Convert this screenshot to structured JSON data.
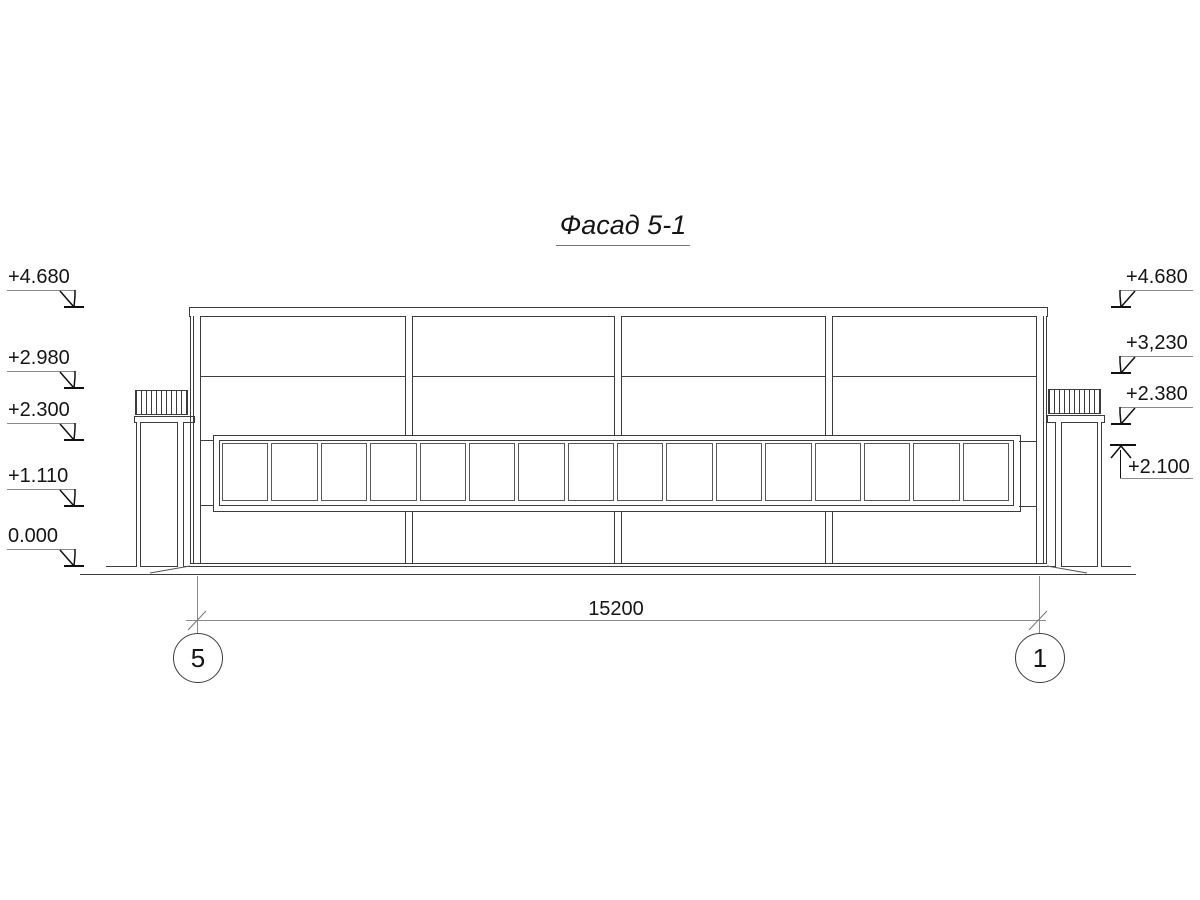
{
  "title": "Фасад 5-1",
  "elevation_marks": {
    "left": [
      {
        "label": "+4.680",
        "direction": "down"
      },
      {
        "label": "+2.980",
        "direction": "down"
      },
      {
        "label": "+2.300",
        "direction": "down"
      },
      {
        "label": "+1.110",
        "direction": "down"
      },
      {
        "label": "0.000",
        "direction": "down"
      }
    ],
    "right": [
      {
        "label": "+4.680",
        "direction": "down"
      },
      {
        "label": "+3,230",
        "direction": "down"
      },
      {
        "label": "+2.380",
        "direction": "down"
      },
      {
        "label": "+2.100",
        "direction": "up"
      }
    ]
  },
  "dimension": {
    "length_label": "15200"
  },
  "axes": {
    "left_label": "5",
    "right_label": "1"
  },
  "window_band": {
    "pane_count": 16
  },
  "colors": {
    "building_line": "#3c3c3c",
    "annotation_line": "#8a8a8a",
    "text": "#151515",
    "background": "#ffffff"
  }
}
